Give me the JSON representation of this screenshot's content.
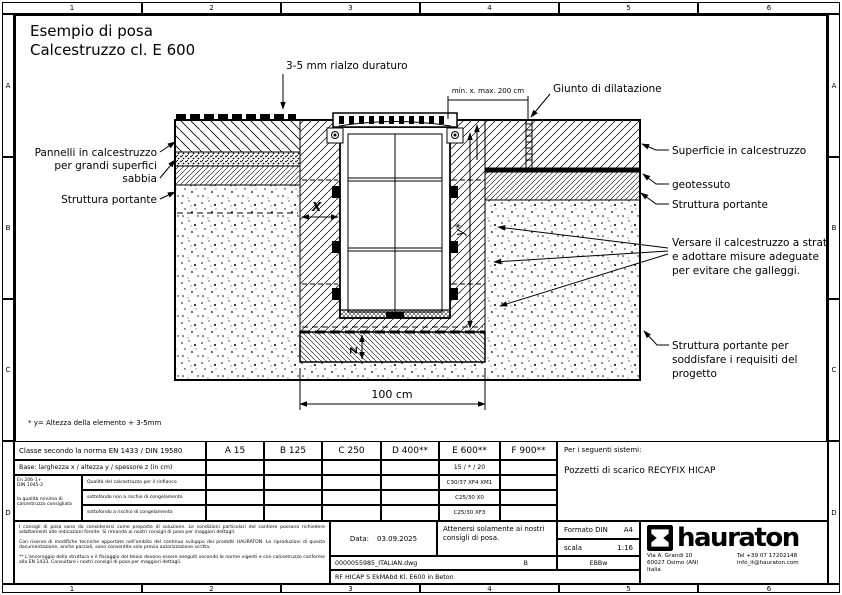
{
  "rulers": {
    "cols": [
      "1",
      "2",
      "3",
      "4",
      "5",
      "6"
    ],
    "rows": [
      "A",
      "B",
      "C",
      "D"
    ]
  },
  "header": {
    "title_line1": "Esempio di posa",
    "title_line2": "Calcestruzzo cl. E 600"
  },
  "annotations": {
    "riser": "3-5 mm rialzo duraturo",
    "min_max": "min. x. max. 200 cm",
    "giunto": "Giunto di dilatazione",
    "left_panel_1": "Pannelli in calcestruzzo",
    "left_panel_2": "per grandi superfici",
    "left_sand": "sabbia",
    "left_portante": "Struttura portante",
    "right_surface": "Superficie in calcestruzzo",
    "right_geo": "geotessuto",
    "right_portante": "Struttura portante",
    "versare_1": "Versare il calcestruzzo a strati",
    "versare_2": "e adottare misure adeguate",
    "versare_3": "per evitare che galleggi.",
    "portante_bottom_1": "Struttura portante per",
    "portante_bottom_2": "soddisfare i requisiti del",
    "portante_bottom_3": "progetto",
    "dim_100": "100 cm",
    "dim_x": "X",
    "dim_y": "y*",
    "dim_z": "Z",
    "footnote": "* y= Altezza della elemento + 3-5mm"
  },
  "table": {
    "load_class_label": "Classe secondo la norma EN 1433 / DIN 19580",
    "classes": [
      "A 15",
      "B 125",
      "C 250",
      "D 400**",
      "E 600**",
      "F 900**"
    ],
    "base_label": "Base: larghezza x / altezza y / spessore z (in cm)",
    "base_value_e600": "15 / * / 20",
    "standards_1": "En 206-1+",
    "standards_2": "DIN 1045-2",
    "quality_note_1": "la qualità minima di",
    "quality_note_2": "calcestruzzo consigliata",
    "row_labels": [
      "Qualità del calcestruzzo per il rinfianco",
      "sottofondo non a rischio di congelamento",
      "sottofondo a rischio di congelamento"
    ],
    "row_values_e600": [
      "C30/37 XF4 XM1",
      "C25/30 X0",
      "C25/30 XF3"
    ],
    "systems_label": "Per i seguenti sistemi:",
    "systems_value": "Pozzetti di scarico RECYFIX HICAP",
    "disclaimer_1": "I consigli di posa sono da considerarsi come proposte di soluzione. Le condizioni particolari del cantiere possono richiedere adattamenti alle indicazioni fornite. Si rimanda ai nostri consigli di posa per maggiori dettagli.",
    "disclaimer_2": "Con riserva di modifiche tecniche apportate nell'ambito del continuo sviluppo dei prodotti HAURATON. Le riproduzioni di questa documentazione, anche parziali, sono consentite solo previa autorizzazione scritta.",
    "disclaimer_3": "** L'ancoraggio della struttura e il fissaggio del telaio devono essere eseguiti secondo le norme vigenti e con calcestruzzo conforme alla EN 1433. Consultare i nostri consigli di posa per maggiori dettagli.",
    "date_label": "Data:",
    "date_value": "03.09.2025",
    "note": "Attenersi solamente ai nostri consigli di posa.",
    "format_label": "Formato DIN",
    "format_value": "A4",
    "scale_label": "scala",
    "scale_value": "1:16",
    "file_name": "0000055985_ITALIAN.dwg",
    "revision": "B",
    "code": "EBBw",
    "doc_title": "RF HICAP S EkMAbd Kl. E600 in Beton",
    "brand": {
      "name": "hauraton",
      "addr1": "Via A. Grandi 10",
      "addr2": "60027 Osimo (AN)",
      "addr3": "Italia",
      "tel": "Tel +39 07 17202148",
      "email": "info_it@hauraton.com"
    }
  }
}
